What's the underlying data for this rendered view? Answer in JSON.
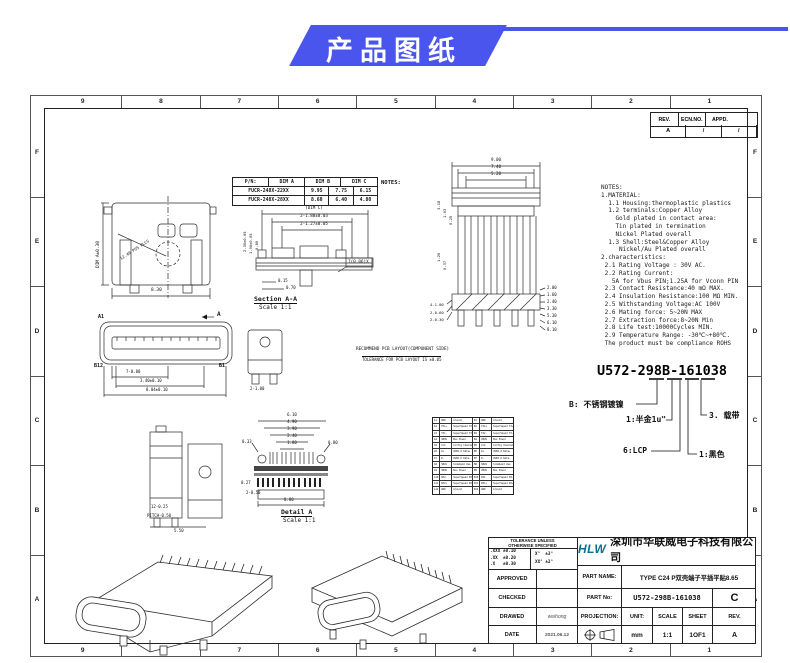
{
  "banner": {
    "title": "产品图纸"
  },
  "colors": {
    "accent": "#4a55ee",
    "line": "#2b2b2b",
    "logo": "#0b6f93"
  },
  "frame": {
    "cols": [
      "9",
      "8",
      "7",
      "6",
      "5",
      "4",
      "3",
      "2",
      "1"
    ],
    "rows": [
      "F",
      "E",
      "D",
      "C",
      "B",
      "A"
    ]
  },
  "rev_table": {
    "headers": [
      "REV.",
      "ECN.NO.",
      "APPD."
    ],
    "values": [
      "A",
      "/",
      "/"
    ]
  },
  "pn_table": {
    "headers": [
      "P/N:",
      "DIM A",
      "DIM B",
      "DIM C"
    ],
    "rows": [
      [
        "FUCR-248X-22XX",
        "9.95",
        "7.75",
        "6.15"
      ],
      [
        "FUCR-248X-28XX",
        "8.60",
        "6.40",
        "4.80"
      ]
    ],
    "side_label": "NOTES:"
  },
  "notes_lines": [
    "NOTES:",
    "1.MATERIAL:",
    "  1.1 Housing:thermoplastic plastics",
    "  1.2 terminals:Copper Alloy",
    "    Gold plated in contact area:",
    "    Tin plated in termination",
    "    Nickel Plated overall",
    "  1.3 Shell:Steel&Copper Alloy",
    "     Nickel/Au Plated overall",
    "2.characteristics:",
    " 2.1 Rating Voltage : 30V AC.",
    " 2.2 Rating Current:",
    "   5A for Vbus PIN;1.25A for Vconn PIN",
    " 2.3 Contact Resistance:40 mΩ MAX.",
    " 2.4 Insulation Resistance:100 MΩ MIN.",
    " 2.5 Withstanding Voltage:AC 100V",
    " 2.6 Mating force: 5~20N MAX",
    " 2.7 Extraction force:8~20N Min",
    " 2.8 Life test:10000Cycles MIN.",
    " 2.9 Temperature Range: -30℃~+80℃.",
    " The product must be compliance ROHS"
  ],
  "callout": {
    "part_number": "U572-298B-161038",
    "shell": "B: 不锈钢镀镍",
    "plating": "1:半金1u\"",
    "material": "6:LCP",
    "color": "1:黑色",
    "packing": "3. 载带"
  },
  "views": {
    "front": {
      "dims": [
        "8.30",
        "DIM A±0.30",
        "12.40 POS PLCS"
      ]
    },
    "section": {
      "title": "Section A-A",
      "scale": "Scale 1:1",
      "top_dims": [
        "(DIM C)",
        "2-1.88±0.03",
        "2-1.27±0.05"
      ],
      "left_dims": [
        "2.30±0.05",
        "1.90±0.05",
        "0.80"
      ],
      "small_dims": [
        "0.15",
        "0.70"
      ],
      "flag": "7(0.06)X"
    },
    "pcb": {
      "top_dims": [
        "9.00",
        "7.40",
        "5.20"
      ],
      "left_dims": [
        "3.18",
        "1.03",
        "0.25",
        "1.20",
        "0.37"
      ],
      "right_dims": [
        "2.00",
        "1.60",
        "2.40",
        "3.30",
        "5.30",
        "6.10",
        "8.10"
      ],
      "bottom_dims": [
        "4-1.00",
        "2-0.60",
        "2-0.30"
      ],
      "caption1": "RECOMMEND PCB LAYOUT(COMPONENT SIDE)",
      "caption2": "TOLERANCE FOR PCB LAYOUT IS ±0.05"
    },
    "face": {
      "labels": [
        "A1",
        "A",
        "B12",
        "B1"
      ],
      "dims": [
        "7-0.80",
        "3.40±0.10",
        "8.04±0.10",
        "2-1.00"
      ]
    },
    "side": {
      "dims": [
        "12-0.25",
        "PITCH-0.50",
        "5.50"
      ]
    },
    "detail": {
      "title": "Detail A",
      "scale": "Scale 1:1",
      "top_dims": [
        "6.10",
        "4.90",
        "3.90",
        "2.40",
        "1.80"
      ],
      "dims": [
        "0.33",
        "0.80",
        "0.27",
        "2-0.50",
        "8.80"
      ]
    }
  },
  "pin_table": {
    "rows": [
      [
        "A1",
        "GND",
        "Ground",
        "B1",
        "GND",
        "Ground"
      ],
      [
        "A2",
        "TX1+",
        "SuperSpeed TX+",
        "B2",
        "TX2+",
        "SuperSpeed TX+"
      ],
      [
        "A3",
        "TX1-",
        "SuperSpeed TX-",
        "B3",
        "TX2-",
        "SuperSpeed TX-"
      ],
      [
        "A4",
        "VBUS",
        "Bus Power",
        "B4",
        "VBUS",
        "Bus Power"
      ],
      [
        "A5",
        "CC1",
        "Config Channel",
        "B5",
        "CC2",
        "Config Channel"
      ],
      [
        "A6",
        "D+",
        "USB2.0 Data+",
        "B6",
        "D+",
        "USB2.0 Data+"
      ],
      [
        "A7",
        "D-",
        "USB2.0 Data-",
        "B7",
        "D-",
        "USB2.0 Data-"
      ],
      [
        "A8",
        "SBU1",
        "Sideband Use",
        "B8",
        "SBU2",
        "Sideband Use"
      ],
      [
        "A9",
        "VBUS",
        "Bus Power",
        "B9",
        "VBUS",
        "Bus Power"
      ],
      [
        "A10",
        "RX2-",
        "SuperSpeed RX-",
        "B10",
        "RX1-",
        "SuperSpeed RX-"
      ],
      [
        "A11",
        "RX2+",
        "SuperSpeed RX+",
        "B11",
        "RX1+",
        "SuperSpeed RX+"
      ],
      [
        "A12",
        "GND",
        "Ground",
        "B12",
        "GND",
        "Ground"
      ]
    ]
  },
  "title_block": {
    "tolerance": {
      "title1": "TOLERANCE UNLESS",
      "title2": "OTHERWISE SPECIFIED",
      "linear": [
        ".XXX ±0.10",
        ".XX  ±0.20",
        ".X   ±0.30"
      ],
      "angular": [
        "X°  ±3°",
        "XX° ±2°"
      ]
    },
    "rows": [
      {
        "label": "APPROVED",
        "value": ""
      },
      {
        "label": "CHECKED",
        "value": ""
      },
      {
        "label": "DRAWED",
        "value": "weihong"
      },
      {
        "label": "DATE",
        "value": "2021.06.12"
      }
    ],
    "company": {
      "logo": "HLW",
      "name_cn": "深圳市华联威电子科技有限公司",
      "name_en": "HUA LIAN WEI TECHNOLOGY ELECTRONICS CO.,LTD."
    },
    "part_name_label": "PART NAME:",
    "part_name": "TYPE C24 P双壳端子平插平贴8.65",
    "part_no_label": "PART No:",
    "part_no": "U572-298B-161038",
    "size": "C",
    "projection_label": "PROJECTION:",
    "unit_label": "UNIT:",
    "unit": "mm",
    "scale_label": "SCALE",
    "scale": "1:1",
    "sheet_label": "SHEET",
    "sheet": "1OF1",
    "rev_label": "REV.",
    "rev": "A"
  }
}
